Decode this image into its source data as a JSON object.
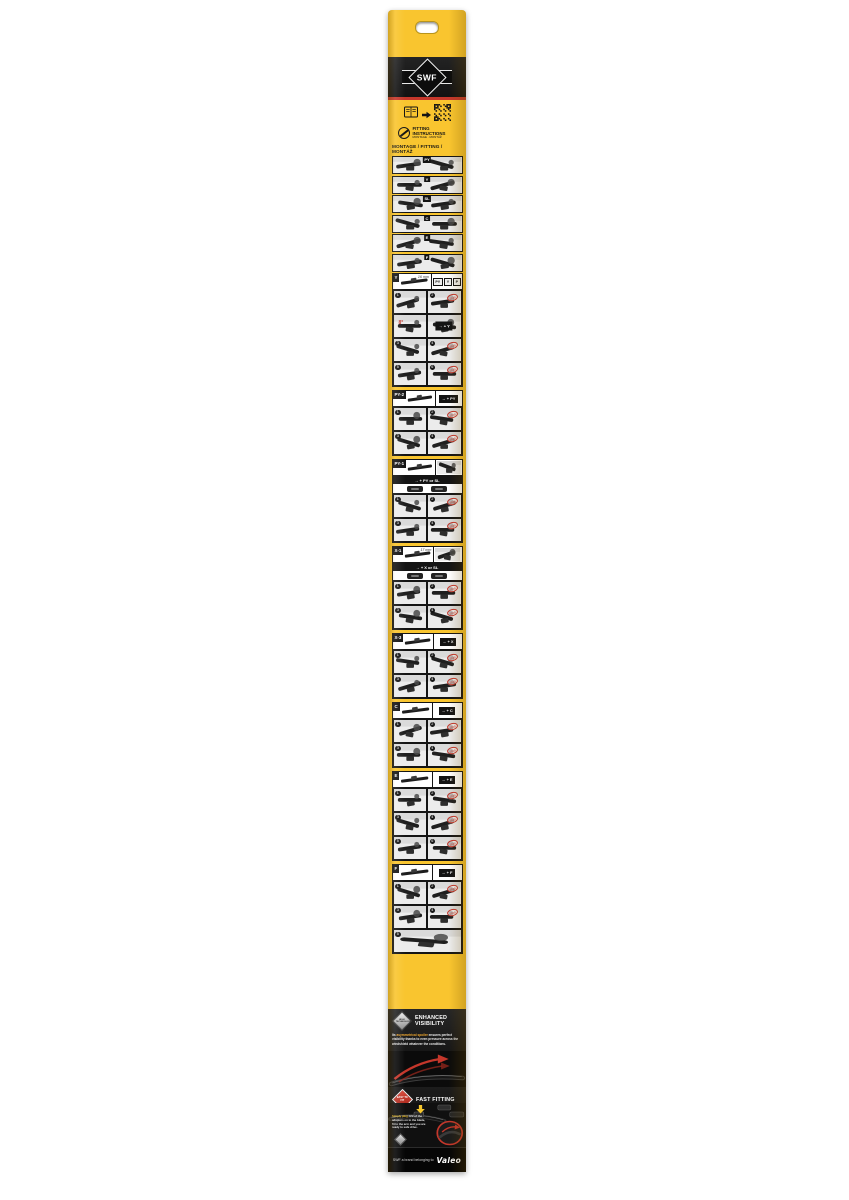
{
  "brand": "SWF",
  "top": {
    "fitting_instructions": "FITTING INSTRUCTIONS",
    "fitting_sub": "MONTAGE · MONTÁŽ",
    "heading": "MONTAGE / FITTING / MONTÁŽ"
  },
  "icons": {
    "booklet": "booklet-icon",
    "arrow": "arrow-right-icon",
    "qr": "qr-code-icon",
    "wiper_circle": "wiper-blade-circle-icon"
  },
  "labels": {
    "click": "click"
  },
  "overview": {
    "rows": [
      {
        "label": "PY"
      },
      {
        "label": "Y"
      },
      {
        "label": "SL"
      },
      {
        "label": "C"
      },
      {
        "label": "E"
      },
      {
        "label": "F"
      }
    ]
  },
  "sections": [
    {
      "code": "Y",
      "measure": "16 mm",
      "compare": [
        "PY",
        "Y",
        "P"
      ],
      "formula": "→ + Y",
      "angle": "8°",
      "steps": 8
    },
    {
      "code": "PY-2",
      "measure": "",
      "formula": "→ + PY",
      "steps": 4
    },
    {
      "code": "PY-1",
      "measure": "",
      "formula": "→ + PY or SL",
      "strip": true,
      "steps": 4
    },
    {
      "code": "X-1",
      "measure": "17 mm",
      "formula": "→ + X or SL",
      "strip": true,
      "steps": 4
    },
    {
      "code": "X-3",
      "measure": "",
      "formula": "→ + X",
      "steps": 4
    },
    {
      "code": "C",
      "measure": "",
      "formula": "→ + C",
      "steps": 4
    },
    {
      "code": "E",
      "measure": "",
      "formula": "→ + E",
      "steps": 6
    },
    {
      "code": "F",
      "measure": "",
      "formula": "→ + F",
      "steps": 5
    }
  ],
  "features": {
    "enhanced": {
      "badge": "HIGH TECHNOLOGY",
      "title": "ENHANCED VISIBILITY",
      "body_pre": "Its ",
      "body_highlight": "asymmetrical spoiler",
      "body_rest": " ensures perfect visibility thanks to even pressure across the windshield whatever the conditions."
    },
    "fast": {
      "badge": "EASY TO FIT",
      "title": "FAST FITTING",
      "body_highlight": "Simply plug",
      "body_rest": " one of the adapters on to the blade, fit to the arm and you are ready to safe drive."
    }
  },
  "colors": {
    "yellow": "#F9C52F",
    "red": "#C5372B",
    "black": "#141414",
    "highlight_orange": "#F0A72E"
  },
  "footer": {
    "text": "SWF a brand belonging to",
    "logo": "Valeo"
  }
}
